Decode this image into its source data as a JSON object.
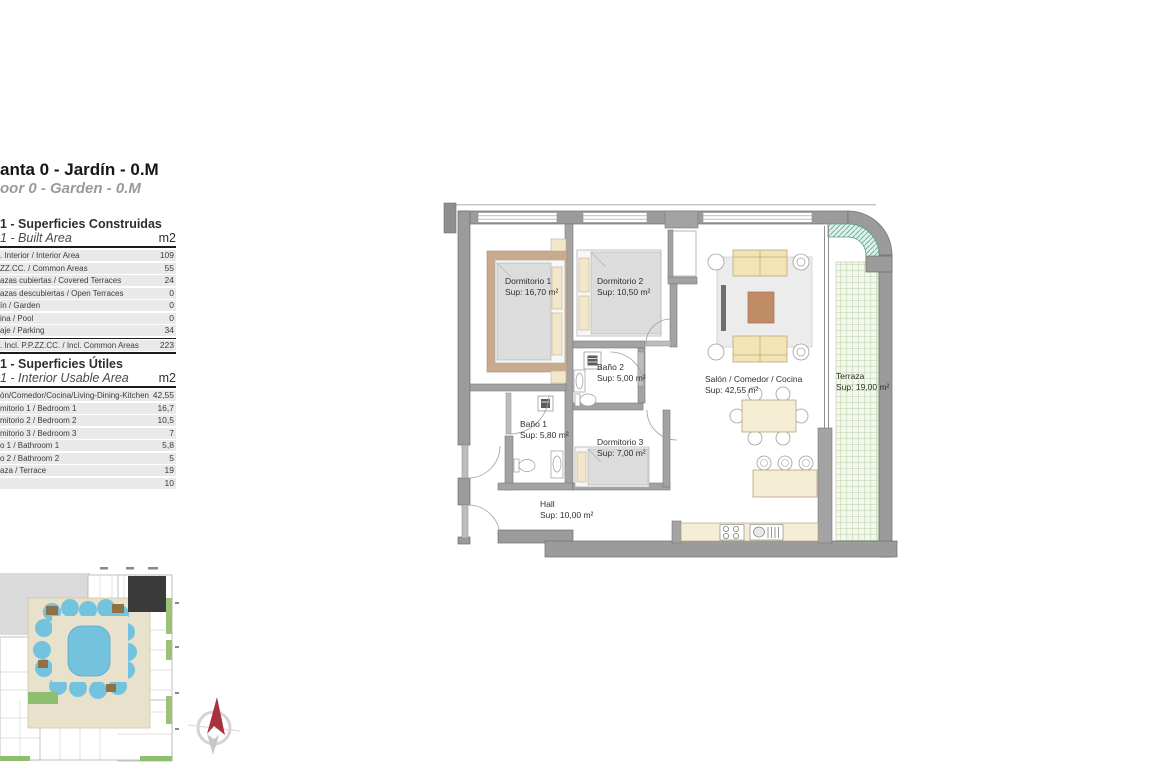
{
  "page": {
    "title": "anta 0 - Jardín - 0.M",
    "subtitle": "oor 0 - Garden - 0.M"
  },
  "tables": [
    {
      "title": "1 - Superficies Construidas",
      "subtitle": "1 - Built Area",
      "unit": "m2",
      "rows": [
        {
          "label": ". Interior / Interior Area",
          "value": "109"
        },
        {
          "label": "ZZ.CC. / Common Areas",
          "value": "55"
        },
        {
          "label": "azas cubiertas / Covered Terraces",
          "value": "24"
        },
        {
          "label": "azas descubiertas / Open Terraces",
          "value": "0"
        },
        {
          "label": "ín / Garden",
          "value": "0"
        },
        {
          "label": "ina / Pool",
          "value": "0"
        },
        {
          "label": "aje / Parking",
          "value": "34"
        },
        {
          "label": ". Incl. P.P.ZZ.CC. / Incl. Common Areas",
          "value": "223"
        }
      ]
    },
    {
      "title": "1 - Superficies Útiles",
      "subtitle": "1 - Interior Usable Area",
      "unit": "m2",
      "rows": [
        {
          "label": "ón/Comedor/Cocina/Living-Dining-Kitchen",
          "value": "42,55"
        },
        {
          "label": "mitorio 1 / Bedroom 1",
          "value": "16,7"
        },
        {
          "label": "mitorio 2 / Bedroom 2",
          "value": "10,5"
        },
        {
          "label": "mitorio 3 / Bedroom 3",
          "value": "7"
        },
        {
          "label": "o 1 / Bathroom 1",
          "value": "5,8"
        },
        {
          "label": "o 2 / Bathroom 2",
          "value": "5"
        },
        {
          "label": "aza / Terrace",
          "value": "19"
        },
        {
          "label": "",
          "value": "10"
        }
      ]
    }
  ],
  "plan": {
    "rooms": [
      {
        "name": "Dormitorio 1",
        "sup": "Sup: 16,70 m²"
      },
      {
        "name": "Dormitorio 2",
        "sup": "Sup: 10,50 m²"
      },
      {
        "name": "Baño 2",
        "sup": "Sup: 5,00 m²"
      },
      {
        "name": "Baño 1",
        "sup": "Sup: 5,80 m²"
      },
      {
        "name": "Dormitorio 3",
        "sup": "Sup: 7,00 m²"
      },
      {
        "name": "Salón / Comedor / Cocina",
        "sup": "Sup: 42,55 m²"
      },
      {
        "name": "Terraza",
        "sup": "Sup: 19,00 m²"
      },
      {
        "name": "Hall",
        "sup": "Sup: 10,00 m²"
      }
    ]
  },
  "colors": {
    "wall_gray": "#9b9b9b",
    "furniture_cream": "#f2e4b8",
    "rug_brown": "#c9aa8f",
    "lawn_green": "#a9c695",
    "planter_teal": "#6fb5a0",
    "pool_blue": "#74c3de",
    "highlight_unit_dark": "#3a3a3a",
    "compass_red": "#a8323c"
  }
}
